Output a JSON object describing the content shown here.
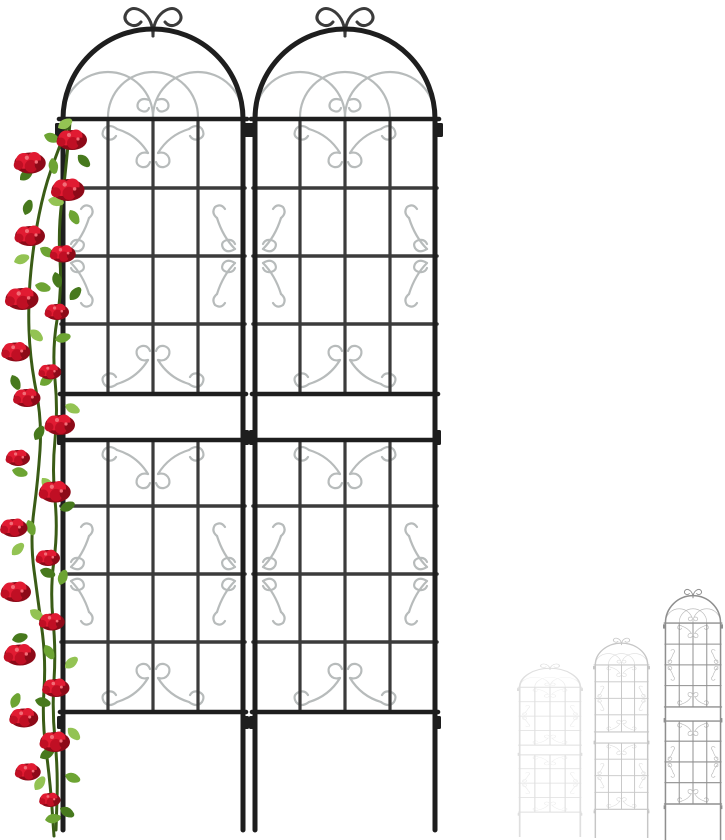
{
  "colors": {
    "background": "#ffffff",
    "frame": "#1e1e1e",
    "bar": "#3b3b3b",
    "scroll": "#b7bbbb",
    "stem": "#3a5c16",
    "rose": "#e11b32",
    "rose-mid": "#c00f24",
    "rose-dark": "#8d0a18",
    "rose-light": "#f26d77"
  },
  "scene": {
    "trellis_panels": [
      {
        "name": "trellis-panel-left",
        "x": 63
      },
      {
        "name": "trellis-panel-right",
        "x": 255
      }
    ],
    "mini_trellises": [
      {
        "name": "size-variant-small",
        "x": 517,
        "y": 663,
        "width": 66,
        "height": 174,
        "stroke": "#dfdfdf",
        "ornament": "#ededed"
      },
      {
        "name": "size-variant-medium",
        "x": 593,
        "y": 637,
        "width": 57,
        "height": 201,
        "stroke": "#c6c6c6",
        "ornament": "#dcdcdc"
      },
      {
        "name": "size-variant-large",
        "x": 663,
        "y": 588,
        "width": 60,
        "height": 252,
        "stroke": "#8f8f8f",
        "ornament": "#bdbdbd"
      }
    ],
    "rose_vine": {
      "leaf_shades": [
        "#6da433",
        "#47791d",
        "#93c353"
      ],
      "stems": [
        [
          [
            70,
            120
          ],
          [
            58,
            150
          ],
          [
            44,
            190
          ],
          [
            34,
            240
          ],
          [
            28,
            300
          ],
          [
            30,
            360
          ],
          [
            42,
            420
          ],
          [
            38,
            480
          ],
          [
            30,
            540
          ],
          [
            38,
            600
          ],
          [
            46,
            660
          ],
          [
            42,
            720
          ],
          [
            50,
            780
          ],
          [
            54,
            836
          ]
        ],
        [
          [
            70,
            122
          ],
          [
            66,
            170
          ],
          [
            58,
            230
          ],
          [
            62,
            290
          ],
          [
            52,
            350
          ],
          [
            58,
            410
          ],
          [
            52,
            470
          ],
          [
            58,
            530
          ],
          [
            50,
            590
          ],
          [
            56,
            650
          ],
          [
            52,
            710
          ],
          [
            58,
            770
          ],
          [
            56,
            830
          ]
        ]
      ],
      "flowers": [
        [
          72,
          140,
          1.0
        ],
        [
          30,
          163,
          1.05
        ],
        [
          68,
          190,
          1.1
        ],
        [
          30,
          236,
          1.0
        ],
        [
          63,
          254,
          0.85
        ],
        [
          22,
          299,
          1.1
        ],
        [
          57,
          312,
          0.8
        ],
        [
          16,
          352,
          0.95
        ],
        [
          50,
          372,
          0.75
        ],
        [
          27,
          398,
          0.9
        ],
        [
          60,
          425,
          1.0
        ],
        [
          18,
          458,
          0.8
        ],
        [
          55,
          492,
          1.05
        ],
        [
          14,
          528,
          0.9
        ],
        [
          48,
          558,
          0.8
        ],
        [
          16,
          592,
          1.0
        ],
        [
          52,
          622,
          0.85
        ],
        [
          20,
          655,
          1.05
        ],
        [
          56,
          688,
          0.9
        ],
        [
          24,
          718,
          0.95
        ],
        [
          55,
          742,
          1.0
        ],
        [
          28,
          772,
          0.85
        ],
        [
          50,
          800,
          0.7
        ]
      ],
      "leaves": [
        [
          58,
          128,
          -30,
          2
        ],
        [
          44,
          135,
          20,
          0
        ],
        [
          78,
          155,
          45,
          1
        ],
        [
          52,
          158,
          80,
          0
        ],
        [
          20,
          180,
          -40,
          1
        ],
        [
          48,
          200,
          10,
          2
        ],
        [
          70,
          210,
          60,
          0
        ],
        [
          25,
          215,
          -70,
          1
        ],
        [
          40,
          248,
          30,
          0
        ],
        [
          14,
          262,
          -20,
          2
        ],
        [
          55,
          272,
          75,
          1
        ],
        [
          35,
          285,
          15,
          0
        ],
        [
          70,
          300,
          -50,
          1
        ],
        [
          30,
          330,
          40,
          2
        ],
        [
          55,
          340,
          -15,
          0
        ],
        [
          12,
          375,
          65,
          1
        ],
        [
          40,
          385,
          -35,
          0
        ],
        [
          65,
          405,
          25,
          2
        ],
        [
          35,
          440,
          -60,
          1
        ],
        [
          12,
          470,
          15,
          0
        ],
        [
          42,
          478,
          50,
          2
        ],
        [
          60,
          510,
          -25,
          1
        ],
        [
          28,
          520,
          70,
          0
        ],
        [
          12,
          555,
          -45,
          2
        ],
        [
          40,
          570,
          20,
          1
        ],
        [
          60,
          585,
          -70,
          0
        ],
        [
          30,
          610,
          35,
          2
        ],
        [
          12,
          640,
          -15,
          1
        ],
        [
          45,
          645,
          60,
          0
        ],
        [
          65,
          668,
          -40,
          2
        ],
        [
          35,
          700,
          15,
          1
        ],
        [
          12,
          708,
          -65,
          0
        ],
        [
          68,
          728,
          45,
          2
        ],
        [
          40,
          758,
          -30,
          1
        ],
        [
          65,
          775,
          20,
          0
        ],
        [
          35,
          790,
          -55,
          2
        ],
        [
          60,
          808,
          30,
          1
        ],
        [
          45,
          820,
          -10,
          0
        ]
      ]
    }
  }
}
